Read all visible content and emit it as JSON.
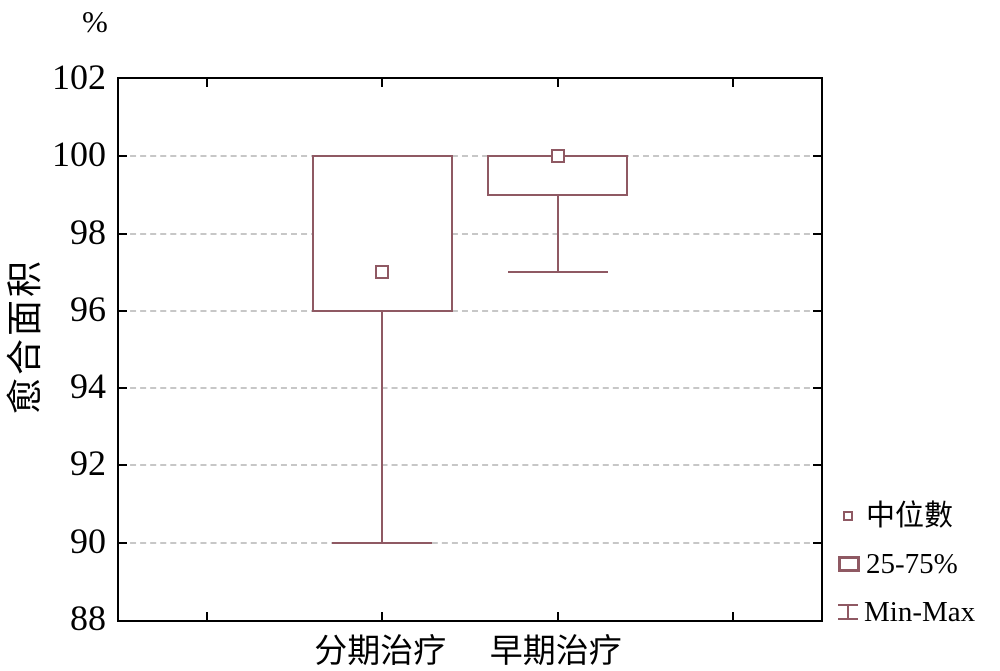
{
  "chart_data": {
    "type": "boxplot",
    "title": "",
    "y_axis": {
      "unit": "%",
      "label": "愈合面积",
      "min": 88,
      "max": 102,
      "tick_step": 2,
      "ticks": [
        102,
        100,
        98,
        96,
        94,
        92,
        90,
        88
      ],
      "gridline_ticks": [
        100,
        98,
        96,
        94,
        92,
        90
      ],
      "grid": "dashed"
    },
    "categories": [
      "分期治疗",
      "早期治疗"
    ],
    "category_x_fractions": [
      0.375,
      0.625
    ],
    "axis_tick_fractions": [
      0.125,
      0.375,
      0.625,
      0.875
    ],
    "series": [
      {
        "category": "分期治疗",
        "median": 97,
        "q1": 96,
        "q3": 100,
        "min": 90,
        "max": 100
      },
      {
        "category": "早期治疗",
        "median": 100,
        "q1": 99,
        "q3": 100,
        "min": 97,
        "max": 100
      }
    ],
    "legend": {
      "position": "bottom-right-outside",
      "items": [
        {
          "icon": "median-marker-icon",
          "label": "中位數"
        },
        {
          "icon": "box-25-75-icon",
          "label": "25-75%"
        },
        {
          "icon": "minmax-whisker-icon",
          "label": "Min-Max"
        }
      ]
    }
  },
  "colors": {
    "box": "#8f5963",
    "grid": "#c7c7c7",
    "axis": "#000000",
    "text": "#000000",
    "background": "#ffffff"
  }
}
